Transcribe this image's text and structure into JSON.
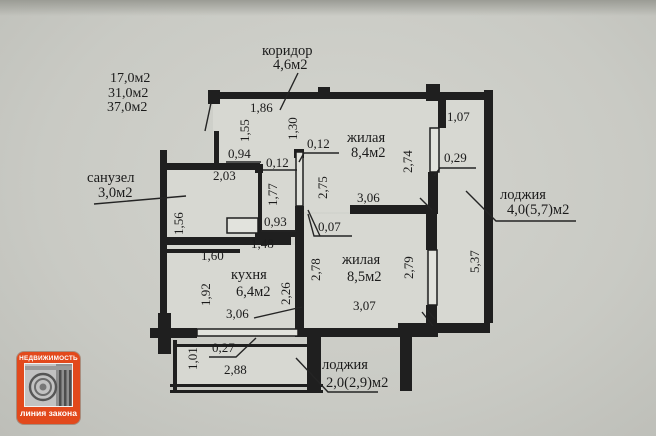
{
  "summary": {
    "l1": "17,0м2",
    "l2": "31,0м2",
    "l3": "37,0м2"
  },
  "rooms": {
    "corridor": {
      "name": "коридор",
      "area": "4,6м2"
    },
    "bathroom": {
      "name": "санузел",
      "area": "3,0м2"
    },
    "living_top": {
      "name": "жилая",
      "area": "8,4м2"
    },
    "loggia_right": {
      "name": "лоджия",
      "area": "4,0(5,7)м2"
    },
    "kitchen": {
      "name": "кухня",
      "area": "6,4м2"
    },
    "living_bottom": {
      "name": "жилая",
      "area": "8,5м2"
    },
    "loggia_bottom": {
      "name": "лоджия",
      "area": "2,0(2,9)м2"
    }
  },
  "dims": {
    "t186": "1,86",
    "v155": "1,55",
    "v130": "1,30",
    "w094": "0,94",
    "w012_left": "0,12",
    "w012_right": "0,12",
    "b203": "2,03",
    "v177": "1,77",
    "v156": "1,56",
    "w093": "0,93",
    "w148": "1,48",
    "w160": "1,60",
    "v192": "1,92",
    "v226": "2,26",
    "k306": "3,06",
    "w027": "0,27",
    "v101": "1,01",
    "l288": "2,88",
    "v275": "2,75",
    "l1306": "3,06",
    "v274": "2,74",
    "s107": "1,07",
    "s029": "0,29",
    "w007": "0,07",
    "v278": "2,78",
    "v279": "2,79",
    "l2307": "3,07",
    "v537": "5,37"
  },
  "logo": {
    "top": "НЕДВИЖИМОСТЬ",
    "bottom": "линия закона",
    "accent": "#e2491c"
  }
}
